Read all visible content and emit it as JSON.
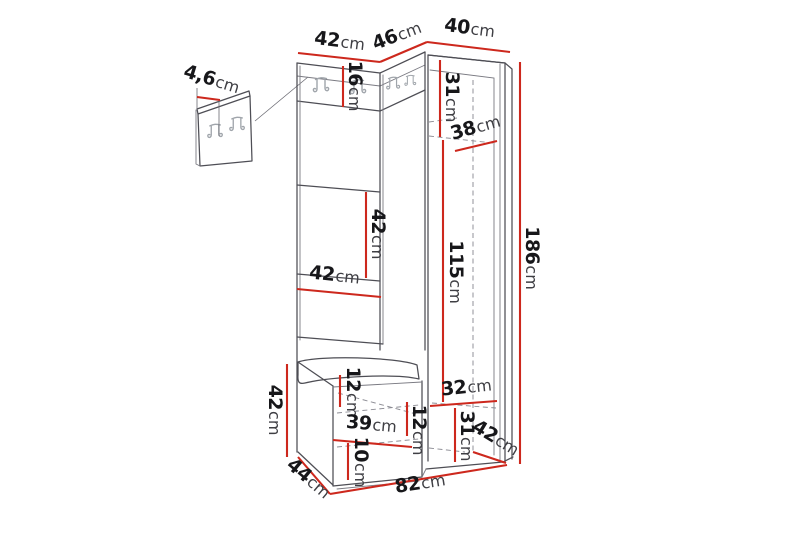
{
  "diagram": {
    "description": "Technical dimension drawing of a corner hallway furniture set (coat rack panel with hooks, open wardrobe shelves, tall side cabinet and seat bench)",
    "unit": "cm",
    "elements": {
      "coat_hooks_on_rail": 4,
      "wall_panel_hooks": 2
    },
    "colors": {
      "background": "#ffffff",
      "outline": "#4e4e55",
      "hidden_line": "#8d8d95",
      "dimension_line": "#cd281d",
      "number_text": "#17171a",
      "unit_text": "#3f3f44"
    },
    "dims": {
      "wall_panel_thickness": {
        "value": "4,6",
        "unit": "cm"
      },
      "top_section_left_width": {
        "value": "42",
        "unit": "cm"
      },
      "top_section_corner_width": {
        "value": "46",
        "unit": "cm"
      },
      "top_section_right_width": {
        "value": "40",
        "unit": "cm"
      },
      "hook_rail_height": {
        "value": "16",
        "unit": "cm"
      },
      "right_top_inner_height": {
        "value": "31",
        "unit": "cm"
      },
      "right_shelf_depth": {
        "value": "38",
        "unit": "cm"
      },
      "middle_inner_height": {
        "value": "42",
        "unit": "cm"
      },
      "middle_inner_width": {
        "value": "42",
        "unit": "cm"
      },
      "right_inner_height": {
        "value": "115",
        "unit": "cm"
      },
      "total_height": {
        "value": "186",
        "unit": "cm"
      },
      "bench_height": {
        "value": "42",
        "unit": "cm"
      },
      "bench_top_inner_height": {
        "value": "12",
        "unit": "cm"
      },
      "bench_inner_width": {
        "value": "39",
        "unit": "cm"
      },
      "bench_right_inner_height": {
        "value": "12",
        "unit": "cm"
      },
      "bench_bottom_inner_height": {
        "value": "10",
        "unit": "cm"
      },
      "bench_depth": {
        "value": "44",
        "unit": "cm"
      },
      "right_bottom_inner_width": {
        "value": "32",
        "unit": "cm"
      },
      "right_bottom_inner_height": {
        "value": "31",
        "unit": "cm"
      },
      "right_cabinet_depth": {
        "value": "42",
        "unit": "cm"
      },
      "total_width": {
        "value": "82",
        "unit": "cm"
      }
    }
  }
}
